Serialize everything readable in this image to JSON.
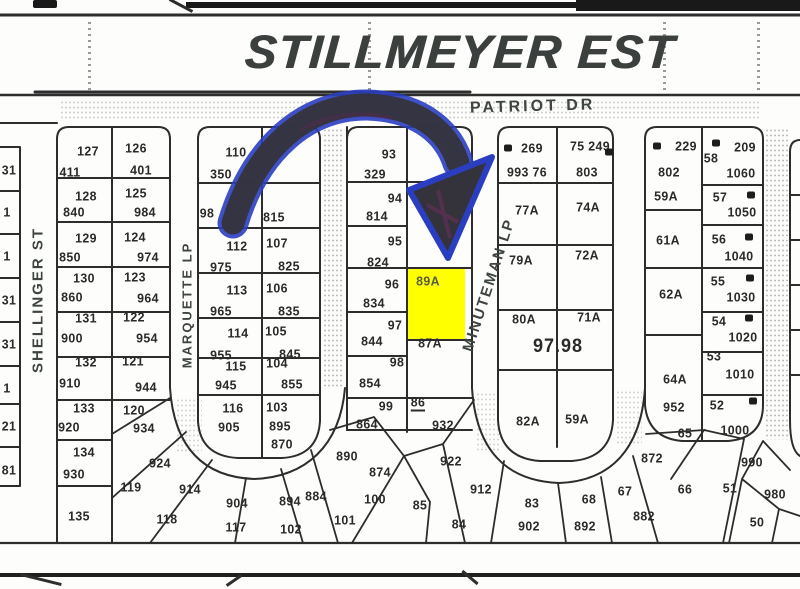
{
  "document": {
    "title": "STILLMEYER EST"
  },
  "streets": {
    "patriot": "PATRIOT DR",
    "shellinger": "SHELLINGER ST",
    "marquette": "MARQUETTE LP",
    "minuteman": "MINUTEMAN LP"
  },
  "highlight": {
    "parcel": "89A",
    "color": "#FFFF00"
  },
  "annotation": {
    "type": "hand-drawn arrow",
    "stroke": "#2b3ec2",
    "fill": "#34333b",
    "points_to": "89A"
  },
  "map": {
    "labels": [
      [
        "31",
        9,
        170
      ],
      [
        "1",
        7,
        212
      ],
      [
        "1",
        7,
        256
      ],
      [
        "31",
        9,
        300
      ],
      [
        "31",
        9,
        344
      ],
      [
        "1",
        7,
        388
      ],
      [
        "21",
        9,
        426
      ],
      [
        "81",
        9,
        470
      ],
      [
        "127",
        88,
        151
      ],
      [
        "411",
        70,
        172
      ],
      [
        "126",
        136,
        148
      ],
      [
        "401",
        141,
        170
      ],
      [
        "128",
        86,
        196
      ],
      [
        "840",
        74,
        212
      ],
      [
        "125",
        136,
        193
      ],
      [
        "984",
        145,
        212
      ],
      [
        "129",
        86,
        238
      ],
      [
        "850",
        70,
        257
      ],
      [
        "124",
        135,
        237
      ],
      [
        "974",
        148,
        257
      ],
      [
        "130",
        84,
        278
      ],
      [
        "860",
        72,
        297
      ],
      [
        "123",
        135,
        277
      ],
      [
        "964",
        148,
        298
      ],
      [
        "131",
        86,
        318
      ],
      [
        "900",
        72,
        338
      ],
      [
        "122",
        134,
        317
      ],
      [
        "954",
        147,
        338
      ],
      [
        "132",
        86,
        362
      ],
      [
        "910",
        70,
        383
      ],
      [
        "121",
        133,
        361
      ],
      [
        "944",
        146,
        387
      ],
      [
        "133",
        84,
        408
      ],
      [
        "920",
        69,
        427
      ],
      [
        "120",
        134,
        410
      ],
      [
        "934",
        144,
        428
      ],
      [
        "134",
        84,
        452
      ],
      [
        "930",
        74,
        474
      ],
      [
        "135",
        79,
        516
      ],
      [
        "924",
        160,
        463
      ],
      [
        "119",
        131,
        487
      ],
      [
        "914",
        190,
        489
      ],
      [
        "118",
        167,
        519
      ],
      [
        "904",
        237,
        503
      ],
      [
        "117",
        236,
        527
      ],
      [
        "894",
        290,
        501
      ],
      [
        "102",
        291,
        529
      ],
      [
        "884",
        316,
        496
      ],
      [
        "101",
        345,
        520
      ],
      [
        "110",
        236,
        152
      ],
      [
        "350",
        221,
        174
      ],
      [
        "98",
        207,
        213
      ],
      [
        "815",
        274,
        217
      ],
      [
        "112",
        237,
        246
      ],
      [
        "975",
        221,
        267
      ],
      [
        "107",
        277,
        243
      ],
      [
        "825",
        289,
        266
      ],
      [
        "113",
        237,
        290
      ],
      [
        "965",
        221,
        311
      ],
      [
        "106",
        277,
        288
      ],
      [
        "835",
        289,
        311
      ],
      [
        "114",
        238,
        333
      ],
      [
        "955",
        221,
        355
      ],
      [
        "105",
        276,
        331
      ],
      [
        "845",
        290,
        354
      ],
      [
        "115",
        236,
        366
      ],
      [
        "945",
        226,
        385
      ],
      [
        "104",
        277,
        363
      ],
      [
        "855",
        292,
        384
      ],
      [
        "116",
        233,
        408
      ],
      [
        "905",
        229,
        427
      ],
      [
        "103",
        277,
        407
      ],
      [
        "895",
        280,
        426
      ],
      [
        "870",
        282,
        444
      ],
      [
        "93",
        389,
        154
      ],
      [
        "329",
        375,
        174
      ],
      [
        "94",
        395,
        198
      ],
      [
        "814",
        377,
        216
      ],
      [
        "95",
        395,
        241
      ],
      [
        "824",
        378,
        262
      ],
      [
        "96",
        392,
        284
      ],
      [
        "834",
        374,
        303
      ],
      [
        "97",
        395,
        325
      ],
      [
        "844",
        372,
        341
      ],
      [
        "98",
        397,
        362
      ],
      [
        "854",
        370,
        383
      ],
      [
        "99",
        386,
        406
      ],
      [
        "86",
        418,
        403,
        "ul"
      ],
      [
        "89A",
        428,
        281,
        "yel"
      ],
      [
        "87A",
        430,
        343
      ],
      [
        "864",
        367,
        424
      ],
      [
        "932",
        443,
        425
      ],
      [
        "890",
        347,
        456
      ],
      [
        "874",
        380,
        472
      ],
      [
        "100",
        375,
        499
      ],
      [
        "85",
        420,
        505
      ],
      [
        "912",
        481,
        489
      ],
      [
        "922",
        451,
        461
      ],
      [
        "84",
        459,
        524
      ],
      [
        "269",
        532,
        148
      ],
      [
        "993 76",
        527,
        172
      ],
      [
        "75 249",
        590,
        146
      ],
      [
        "803",
        587,
        172
      ],
      [
        "77A",
        527,
        210
      ],
      [
        "74A",
        588,
        207
      ],
      [
        "79A",
        521,
        260
      ],
      [
        "72A",
        587,
        255
      ],
      [
        "80A",
        524,
        319
      ],
      [
        "71A",
        589,
        317
      ],
      [
        "97.98",
        558,
        347,
        "big"
      ],
      [
        "82A",
        528,
        421
      ],
      [
        "59A",
        577,
        419
      ],
      [
        "229",
        686,
        146
      ],
      [
        "802",
        669,
        172
      ],
      [
        "59A",
        666,
        196
      ],
      [
        "61A",
        668,
        240
      ],
      [
        "62A",
        671,
        294
      ],
      [
        "64A",
        675,
        379
      ],
      [
        "209",
        745,
        147
      ],
      [
        "58",
        711,
        158
      ],
      [
        "1060",
        741,
        173
      ],
      [
        "57",
        720,
        197
      ],
      [
        "1050",
        742,
        212
      ],
      [
        "56",
        719,
        239
      ],
      [
        "1040",
        739,
        256
      ],
      [
        "55",
        718,
        281
      ],
      [
        "1030",
        741,
        297
      ],
      [
        "54",
        719,
        321
      ],
      [
        "1020",
        743,
        337
      ],
      [
        "53",
        714,
        356
      ],
      [
        "1010",
        740,
        374
      ],
      [
        "52",
        717,
        405
      ],
      [
        "1000",
        735,
        430
      ],
      [
        "952",
        674,
        407
      ],
      [
        "65",
        685,
        433
      ],
      [
        "872",
        652,
        458
      ],
      [
        "66",
        685,
        489
      ],
      [
        "67",
        625,
        491
      ],
      [
        "882",
        644,
        516
      ],
      [
        "68",
        589,
        499
      ],
      [
        "892",
        585,
        526
      ],
      [
        "83",
        532,
        503
      ],
      [
        "902",
        529,
        526
      ],
      [
        "990",
        752,
        462
      ],
      [
        "51",
        730,
        488
      ],
      [
        "980",
        775,
        494
      ],
      [
        "50",
        757,
        522
      ]
    ],
    "dots": [
      [
        508,
        148
      ],
      [
        609,
        152
      ],
      [
        657,
        146
      ],
      [
        716,
        143
      ],
      [
        751,
        195
      ],
      [
        749,
        237
      ],
      [
        750,
        278
      ],
      [
        749,
        318
      ],
      [
        753,
        401
      ]
    ]
  }
}
